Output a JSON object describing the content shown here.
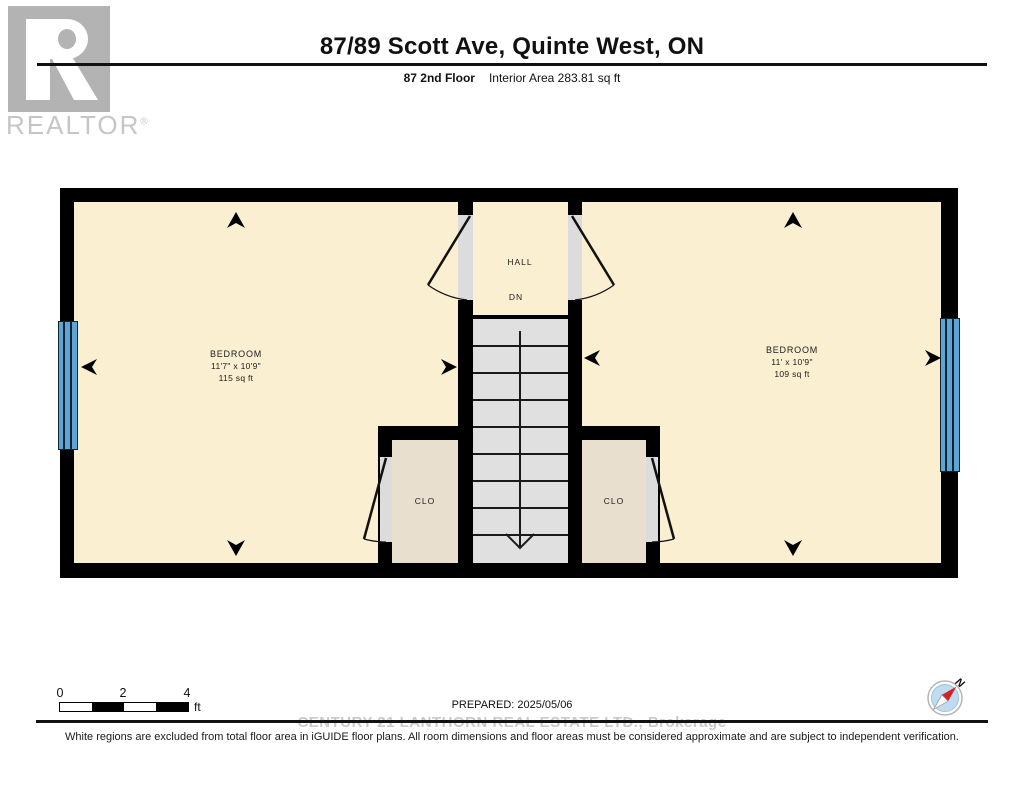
{
  "header": {
    "title": "87/89 Scott Ave, Quinte West, ON",
    "floor_label": "87 2nd Floor",
    "area_label": "Interior Area 283.81 sq ft",
    "logo": {
      "word": "REALTOR",
      "reg": "®"
    }
  },
  "plan": {
    "bedroom_left": {
      "name": "BEDROOM",
      "dims": "11'7\" x 10'9\"",
      "area": "115 sq ft"
    },
    "bedroom_right": {
      "name": "BEDROOM",
      "dims": "11' x 10'9\"",
      "area": "109 sq ft"
    },
    "hall": {
      "name": "HALL",
      "dn": "DN"
    },
    "closet_left": {
      "name": "CLO"
    },
    "closet_right": {
      "name": "CLO"
    }
  },
  "footer": {
    "scale": {
      "ticks": [
        "0",
        "2",
        "4"
      ],
      "unit": "ft"
    },
    "prepared": "PREPARED: 2025/05/06",
    "compass_n": "N",
    "watermark": "CENTURY 21 LANTHORN REAL ESTATE LTD., Brokerage",
    "disclaimer": "White regions are excluded from total floor area in iGUIDE floor plans. All room dimensions and floor areas must be considered approximate and are subject to independent verification."
  },
  "colors": {
    "room": "#FBEFD1",
    "closet": "#E8DFCF",
    "stairs": "#E0E0E0",
    "jamb": "#DCDCDC",
    "window": "#5CA6D7",
    "wall": "#000000",
    "logo_gray": "#B3B3B3",
    "watermark": "#C9C9C9",
    "compass_face": "#BFDDF1",
    "compass_needle": "#D42127"
  }
}
